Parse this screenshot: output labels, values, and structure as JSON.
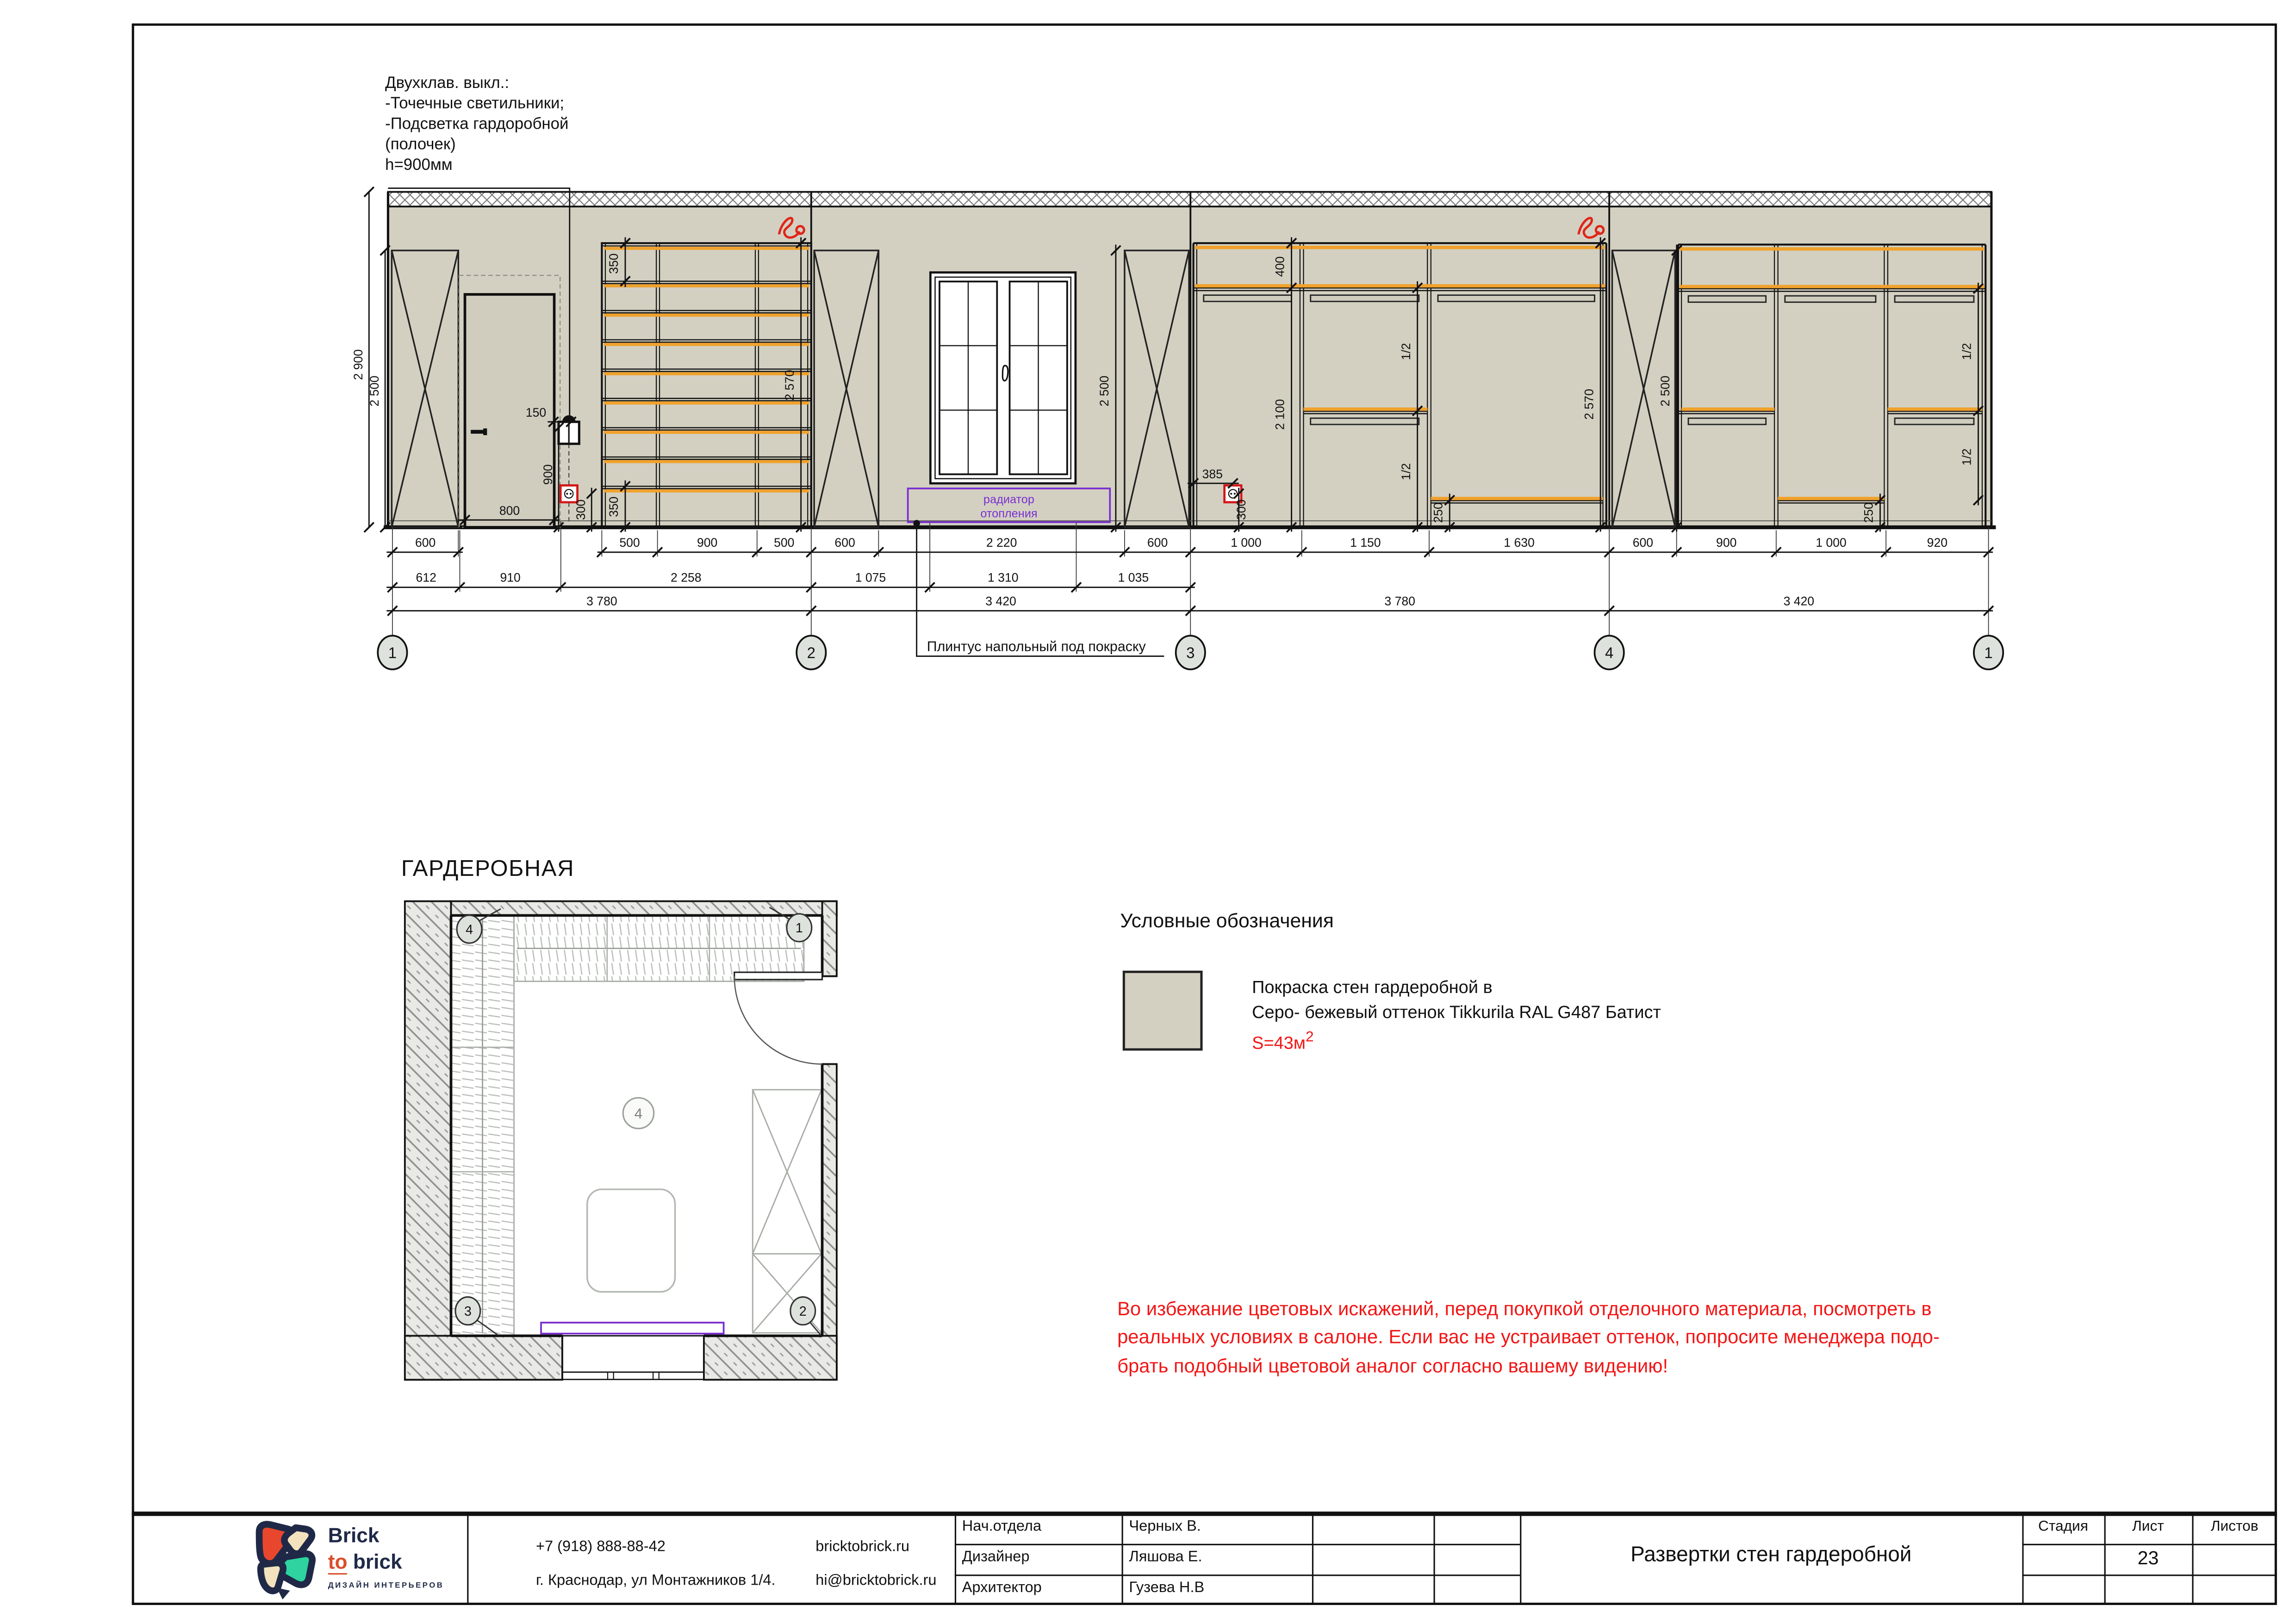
{
  "colors": {
    "wall_beige": "#d3d0c2",
    "shelf_orange": "#f0a12c",
    "warning_red": "#f21616",
    "radiator_violet": "#7b2fd0",
    "axis_bubble_fill": "#dde3dc",
    "logo_navy": "#1f2947",
    "logo_red": "#e8472e",
    "logo_green": "#2ed3a0",
    "logo_cream": "#f2e2bd"
  },
  "annotation": {
    "line1": "Двухклав. выкл.:",
    "line2": "-Точечные светильники;",
    "line3": "-Подсветка гардоробной",
    "line4": "(полочек)",
    "line5": "h=900мм"
  },
  "elevation": {
    "axes": [
      "1",
      "2",
      "3",
      "4",
      "1"
    ],
    "dims_top": [
      "600",
      "500",
      "900",
      "500",
      "600",
      "2 220",
      "600",
      "1 000",
      "1 150",
      "1 630",
      "600",
      "900",
      "1 000",
      "920"
    ],
    "dims_mid": [
      "612",
      "910",
      "2 258",
      "1 075",
      "1 310",
      "1 035"
    ],
    "dims_total": [
      "3 780",
      "3 420",
      "3 780",
      "3 420"
    ],
    "dims_v": {
      "d2900": "2 900",
      "d2500": "2 500",
      "d350": "350",
      "d2570": "2 570",
      "d150": "150",
      "d900": "900",
      "d300": "300",
      "d800": "800",
      "d385": "385",
      "d400": "400",
      "d2100": "2 100",
      "dhalf": "1/2",
      "d250": "250"
    },
    "radiator_line1": "радиатор",
    "radiator_line2": "отопления",
    "plinth_note": "Плинтус напольный под покраску"
  },
  "plan": {
    "title": "ГАРДЕРОБНАЯ",
    "bubble_tl": "4",
    "bubble_tr": "1",
    "bubble_bl": "3",
    "bubble_br": "2",
    "center_mark": "4"
  },
  "legend": {
    "title": "Условные обозначения",
    "line1": "Покраска стен гардеробной в",
    "line2": "Серо- бежевый оттенок Tikkurila RAL G487 Батист",
    "area_label": "S=43м",
    "area_sup": "2"
  },
  "warning": {
    "line1": "Во избежание цветовых искажений, перед покупкой отделочного материала, посмотреть в",
    "line2": "реальных условиях в салоне. Если вас не устраивает оттенок, попросите менеджера подо-",
    "line3": "брать подобный цветовой аналог согласно вашему видению!"
  },
  "titleblock": {
    "brand_line1": "Brick",
    "brand_to": "to",
    "brand_line2": "brick",
    "brand_tagline": "ДИЗАЙН ИНТЕРЬЕРОВ",
    "phone": "+7 (918) 888-88-42",
    "address": "г. Краснодар, ул Монтажников 1/4.",
    "website": "bricktobrick.ru",
    "email": "hi@bricktobrick.ru",
    "staff": [
      {
        "role": "Нач.отдела",
        "name": "Черных В."
      },
      {
        "role": "Дизайнер",
        "name": "Ляшова Е."
      },
      {
        "role": "Архитектор",
        "name": "Гузева Н.В"
      }
    ],
    "doc_title": "Развертки стен гардеробной",
    "col_stage": "Стадия",
    "col_sheet": "Лист",
    "col_sheets": "Листов",
    "sheet_number": "23"
  }
}
